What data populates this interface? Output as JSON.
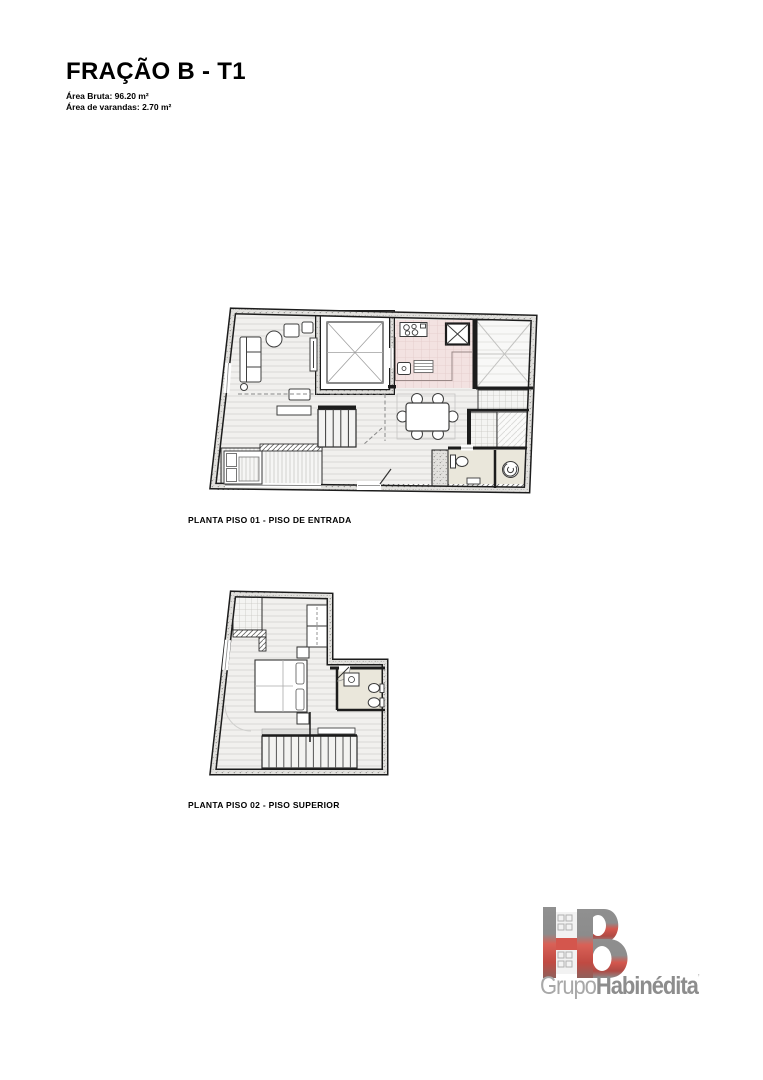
{
  "header": {
    "title": "FRAÇÃO B - T1",
    "area_bruta": "Área Bruta: 96.20 m²",
    "area_varandas": "Área de varandas: 2.70 m²"
  },
  "plans": [
    {
      "id": "piso-01",
      "label": "PLANTA PISO 01 - PISO DE ENTRADA"
    },
    {
      "id": "piso-02",
      "label": "PLANTA PISO 02 - PISO SUPERIOR"
    }
  ],
  "logo": {
    "monogram": "HB",
    "name_light": "Grupo",
    "name_bold": "Habinédita",
    "mark": "’"
  },
  "colors": {
    "kitchen_floor": "#f3e2e1",
    "bathroom_floor": "#eae7db",
    "logo_red": "#d4564d",
    "logo_gray": "#8d8d8d",
    "drawing_line": "#1c1c1c"
  }
}
